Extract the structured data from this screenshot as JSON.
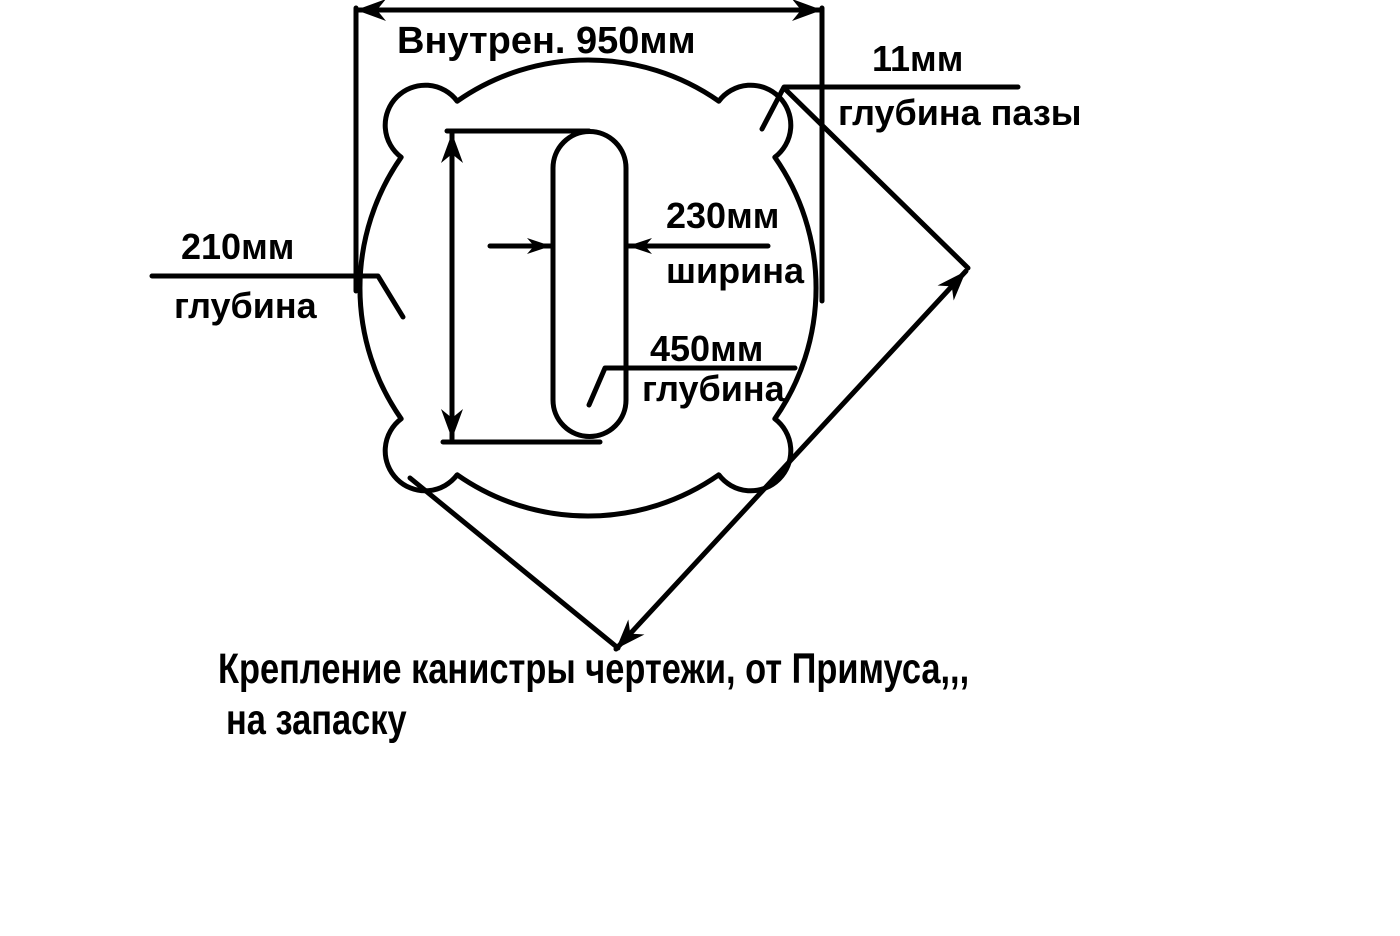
{
  "colors": {
    "ink": "#000000",
    "background": "#ffffff"
  },
  "drawing": {
    "dim_inner_width": {
      "label": "Внутрен. 950мм"
    },
    "dim_groove_depth": {
      "value": "11мм",
      "desc": "глубина пазы"
    },
    "dim_slot_width": {
      "value": "230мм",
      "desc": "ширина"
    },
    "dim_slot_depth": {
      "value": "450мм",
      "desc": "глубина"
    },
    "dim_left_depth": {
      "value": "210мм",
      "desc": "глубина"
    },
    "caption": {
      "line1": "Крепление канистры чертежи, от Примуса,,,",
      "line2": "на запаску"
    }
  }
}
